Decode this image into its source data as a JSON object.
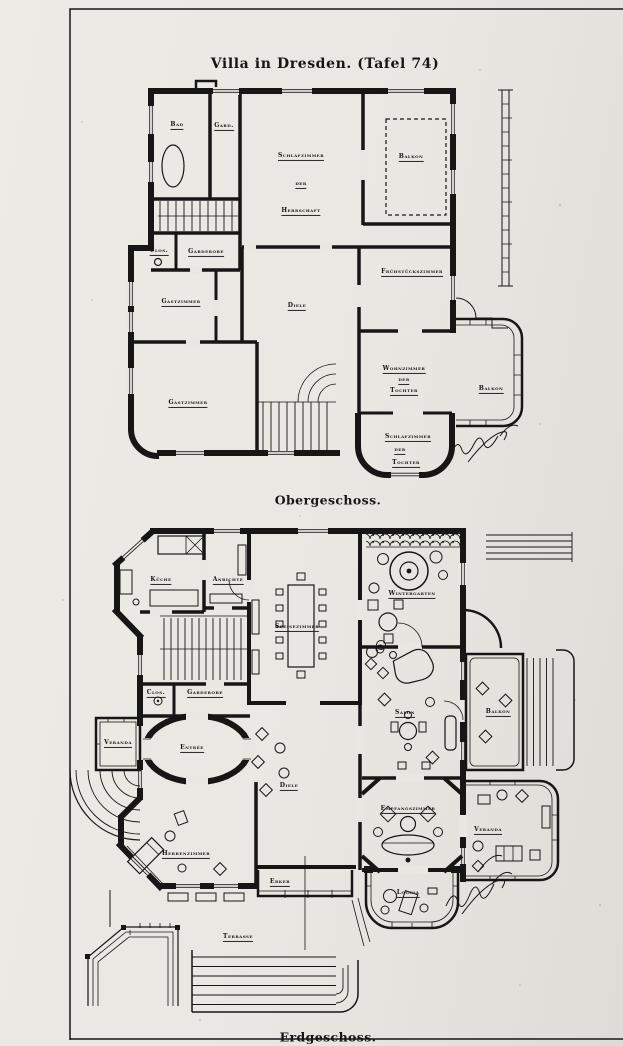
{
  "page": {
    "title": "Villa in Dresden. (Tafel 74)"
  },
  "upper_floor": {
    "caption": "Obergeschoss.",
    "rooms": {
      "bad": "Bad",
      "gard": "Gard.",
      "schlafzimmer_herrschaft": [
        "Schlafzimmer",
        "der",
        "Herrschaft"
      ],
      "balkon_top": "Balkon",
      "clos": "Clos.",
      "garderobe": "Garderobe",
      "gastzimmer_1": "Gastzimmer",
      "diele": "Diele",
      "fruehstueckszimmer": "Frühstückszimmer",
      "gastzimmer_2": "Gastzimmer",
      "wohnzimmer_tochter": [
        "Wohnzimmer",
        "der",
        "Tochter"
      ],
      "balkon_side": "Balkon",
      "schlafzimmer_tochter": [
        "Schlafzimmer",
        "der",
        "Tochter"
      ]
    }
  },
  "ground_floor": {
    "caption": "Erdgeschoss.",
    "rooms": {
      "kueche": "Küche",
      "anrichte": "Anrichte",
      "speisezimmer": "Speisezimmer",
      "wintergarten": "Wintergarten",
      "clos": "Clos.",
      "garderobe": "Garderobe",
      "veranda_left": "Veranda",
      "entree": "Entrée",
      "salon": "Salon",
      "balkon": "Balkon",
      "diele": "Diele",
      "herrenzimmer": "Herrenzimmer",
      "empfangszimmer": "Empfangszimmer",
      "veranda_right": "Veranda",
      "erker": "Erker",
      "loggia": "Loggia",
      "terrasse": "Terrasse"
    }
  },
  "colors": {
    "paper": "#e9e7e1",
    "ink": "#161616"
  }
}
